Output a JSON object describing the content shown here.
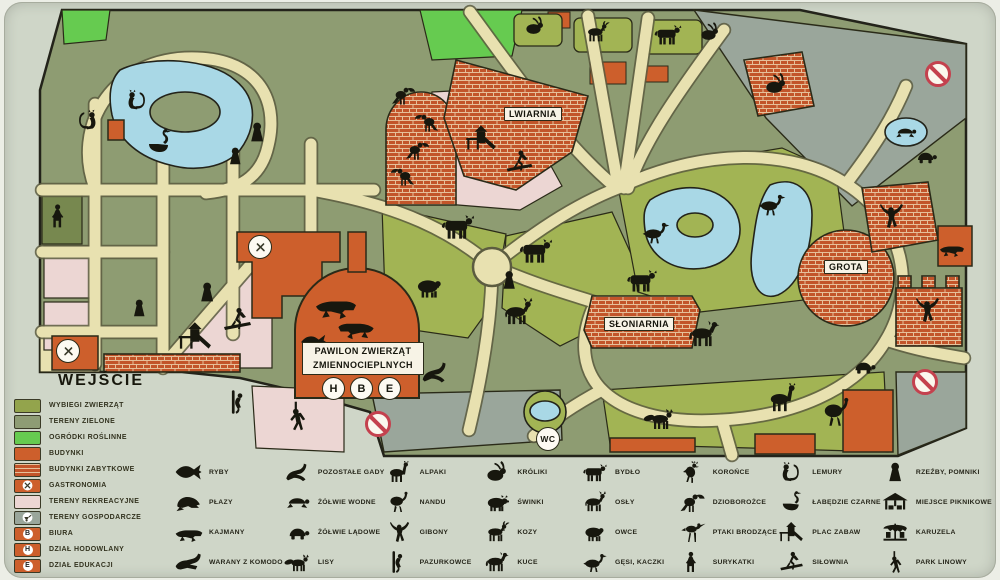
{
  "palette": {
    "sign_bg": "#cfd6c8",
    "terrain_green": "#8e9c72",
    "enclosure_green": "#a2b454",
    "garden_green": "#66cb50",
    "path_beige": "#e8e1b0",
    "water_blue": "#a9d8e6",
    "building_orange": "#cd5f2c",
    "brick_orange": "#c2552a",
    "brick_mortar": "#e6c09a",
    "recreation_pink": "#ecd6d3",
    "utility_gray": "#9aa69b",
    "outline_dark": "#23231535",
    "no_entry_red": "#c4414e",
    "silhouette_black": "#17170e"
  },
  "map": {
    "entrance_label": "WEJŚCIE",
    "labels": {
      "lwiarnia": "LWIARNIA",
      "sloniarnia": "SŁONIARNIA",
      "grota": "GROTA",
      "pawilon_line1": "PAWILON ZWIERZĄT",
      "pawilon_line2": "ZMIENNOCIEPLNYCH"
    },
    "badges": {
      "wc": "WC",
      "h": "H",
      "b": "B",
      "e": "E"
    }
  },
  "legend_zones": {
    "items": [
      {
        "label": "WYBIEGI ZWIERZĄT",
        "swatch": "solid",
        "color": "#93a44c"
      },
      {
        "label": "TERENY ZIELONE",
        "swatch": "solid",
        "color": "#8e9c74"
      },
      {
        "label": "OGRÓDKI ROŚLINNE",
        "swatch": "solid",
        "color": "#66cb50"
      },
      {
        "label": "BUDYNKI",
        "swatch": "solid",
        "color": "#cd5f2c"
      },
      {
        "label": "BUDYNKI ZABYTKOWE",
        "swatch": "brick",
        "color": "#c2552a"
      },
      {
        "label": "GASTRONOMIA",
        "swatch": "icon",
        "color": "#cd5f2c",
        "icon": "utensils-icon"
      },
      {
        "label": "TERENY REKREACYJNE",
        "swatch": "solid",
        "color": "#ecd6d3"
      },
      {
        "label": "TERENY GOSPODARCZE",
        "swatch": "icon",
        "color": "#9aa69b",
        "icon": "cart-icon"
      },
      {
        "label": "BIURA",
        "swatch": "letter",
        "color": "#cd5f2c",
        "letter": "B"
      },
      {
        "label": "DZIAŁ HODOWLANY",
        "swatch": "letter",
        "color": "#cd5f2c",
        "letter": "H"
      },
      {
        "label": "DZIAŁ EDUKACJI",
        "swatch": "letter",
        "color": "#cd5f2c",
        "letter": "E"
      }
    ]
  },
  "legend_animals": {
    "columns": [
      {
        "items": [
          {
            "icon": "fish",
            "label": "RYBY"
          },
          {
            "icon": "frog",
            "label": "PŁAZY"
          },
          {
            "icon": "caiman",
            "label": "KAJMANY"
          },
          {
            "icon": "varan",
            "label": "WARANY Z KOMODO"
          }
        ]
      },
      {
        "items": [
          {
            "icon": "lizard",
            "label": "POZOSTAŁE GADY"
          },
          {
            "icon": "turtle-water",
            "label": "ŻÓŁWIE WODNE"
          },
          {
            "icon": "turtle-land",
            "label": "ŻÓŁWIE LĄDOWE"
          },
          {
            "icon": "fox",
            "label": "LISY"
          }
        ]
      },
      {
        "items": [
          {
            "icon": "alpaca",
            "label": "ALPAKI"
          },
          {
            "icon": "nandu",
            "label": "NANDU"
          },
          {
            "icon": "gibbon",
            "label": "GIBONY"
          },
          {
            "icon": "marmoset",
            "label": "PAZURKOWCE"
          }
        ]
      },
      {
        "items": [
          {
            "icon": "rabbit",
            "label": "KRÓLIKI"
          },
          {
            "icon": "pig",
            "label": "ŚWINKI"
          },
          {
            "icon": "goat",
            "label": "KOZY"
          },
          {
            "icon": "pony",
            "label": "KUCE"
          }
        ]
      },
      {
        "items": [
          {
            "icon": "cow",
            "label": "BYDŁO"
          },
          {
            "icon": "donkey",
            "label": "OSŁY"
          },
          {
            "icon": "sheep",
            "label": "OWCE"
          },
          {
            "icon": "goose",
            "label": "GĘSI, KACZKI"
          }
        ]
      },
      {
        "items": [
          {
            "icon": "crowned-bird",
            "label": "KOROŃCE"
          },
          {
            "icon": "hornbill",
            "label": "DZIOBOROŻCE"
          },
          {
            "icon": "wading-bird",
            "label": "PTAKI BRODZĄCE"
          },
          {
            "icon": "meerkat",
            "label": "SURYKATKI"
          }
        ]
      },
      {
        "items": [
          {
            "icon": "lemur",
            "label": "LEMURY"
          },
          {
            "icon": "swan",
            "label": "ŁABĘDZIE CZARNE"
          },
          {
            "icon": "playground",
            "label": "PLAC ZABAW"
          },
          {
            "icon": "gym",
            "label": "SIŁOWNIA"
          }
        ]
      },
      {
        "items": [
          {
            "icon": "statue",
            "label": "RZEŹBY, POMNIKI"
          },
          {
            "icon": "gazebo",
            "label": "MIEJSCE PIKNIKOWE"
          },
          {
            "icon": "carousel",
            "label": "KARUZELA"
          },
          {
            "icon": "rope-park",
            "label": "PARK LINOWY"
          }
        ]
      }
    ]
  },
  "map_markers": {
    "animals": [
      {
        "icon": "swan",
        "x": 160,
        "y": 142,
        "s": 1.0
      },
      {
        "icon": "lemur",
        "x": 138,
        "y": 100,
        "s": 0.85
      },
      {
        "icon": "lemur",
        "x": 86,
        "y": 120,
        "s": 0.85,
        "flip": true
      },
      {
        "icon": "meerkat",
        "x": 60,
        "y": 216,
        "s": 0.95
      },
      {
        "icon": "hornbill",
        "x": 404,
        "y": 95,
        "s": 0.8
      },
      {
        "icon": "hornbill",
        "x": 426,
        "y": 122,
        "s": 0.8,
        "flip": true
      },
      {
        "icon": "hornbill",
        "x": 418,
        "y": 150,
        "s": 0.8
      },
      {
        "icon": "hornbill",
        "x": 402,
        "y": 176,
        "s": 0.8,
        "flip": true
      },
      {
        "icon": "rabbit",
        "x": 535,
        "y": 26,
        "s": 0.75
      },
      {
        "icon": "goat",
        "x": 597,
        "y": 32,
        "s": 0.85
      },
      {
        "icon": "cow",
        "x": 668,
        "y": 34,
        "s": 0.95
      },
      {
        "icon": "rabbit",
        "x": 710,
        "y": 32,
        "s": 0.75
      },
      {
        "icon": "rabbit",
        "x": 776,
        "y": 84,
        "s": 0.85
      },
      {
        "icon": "cow",
        "x": 458,
        "y": 226,
        "s": 1.15
      },
      {
        "icon": "cow",
        "x": 536,
        "y": 250,
        "s": 1.15
      },
      {
        "icon": "sheep",
        "x": 430,
        "y": 286,
        "s": 1.05
      },
      {
        "icon": "donkey",
        "x": 518,
        "y": 312,
        "s": 1.1
      },
      {
        "icon": "cow",
        "x": 642,
        "y": 280,
        "s": 1.05
      },
      {
        "icon": "pony",
        "x": 704,
        "y": 334,
        "s": 1.1
      },
      {
        "icon": "goose",
        "x": 656,
        "y": 232,
        "s": 0.95
      },
      {
        "icon": "goose",
        "x": 772,
        "y": 204,
        "s": 0.95
      },
      {
        "icon": "turtle-water",
        "x": 906,
        "y": 132,
        "s": 0.75
      },
      {
        "icon": "turtle-land",
        "x": 926,
        "y": 156,
        "s": 0.8
      },
      {
        "icon": "gibbon",
        "x": 892,
        "y": 216,
        "s": 1.0
      },
      {
        "icon": "caiman",
        "x": 952,
        "y": 248,
        "s": 0.75
      },
      {
        "icon": "gibbon",
        "x": 928,
        "y": 310,
        "s": 1.0
      },
      {
        "icon": "turtle-land",
        "x": 864,
        "y": 366,
        "s": 0.85
      },
      {
        "icon": "fox",
        "x": 660,
        "y": 418,
        "s": 1.0
      },
      {
        "icon": "alpaca",
        "x": 784,
        "y": 398,
        "s": 1.1
      },
      {
        "icon": "nandu",
        "x": 838,
        "y": 412,
        "s": 1.15
      },
      {
        "icon": "caiman",
        "x": 336,
        "y": 304,
        "s": 1.25
      },
      {
        "icon": "caiman",
        "x": 356,
        "y": 326,
        "s": 1.1,
        "flip": true
      },
      {
        "icon": "fish",
        "x": 314,
        "y": 342,
        "s": 0.8
      },
      {
        "icon": "lizard",
        "x": 436,
        "y": 372,
        "s": 0.95
      },
      {
        "icon": "playground",
        "x": 196,
        "y": 336,
        "s": 1.15
      },
      {
        "icon": "gym",
        "x": 238,
        "y": 320,
        "s": 1.0
      },
      {
        "icon": "playground",
        "x": 482,
        "y": 138,
        "s": 1.05
      },
      {
        "icon": "gym",
        "x": 520,
        "y": 162,
        "s": 0.95
      },
      {
        "icon": "rope-park",
        "x": 298,
        "y": 416,
        "s": 1.1
      },
      {
        "icon": "marmoset",
        "x": 240,
        "y": 402,
        "s": 0.9
      },
      {
        "icon": "statue",
        "x": 258,
        "y": 132,
        "s": 0.85
      },
      {
        "icon": "statue",
        "x": 236,
        "y": 156,
        "s": 0.75
      },
      {
        "icon": "statue",
        "x": 208,
        "y": 292,
        "s": 0.85
      },
      {
        "icon": "statue",
        "x": 140,
        "y": 308,
        "s": 0.75
      },
      {
        "icon": "statue",
        "x": 510,
        "y": 280,
        "s": 0.8
      }
    ]
  }
}
